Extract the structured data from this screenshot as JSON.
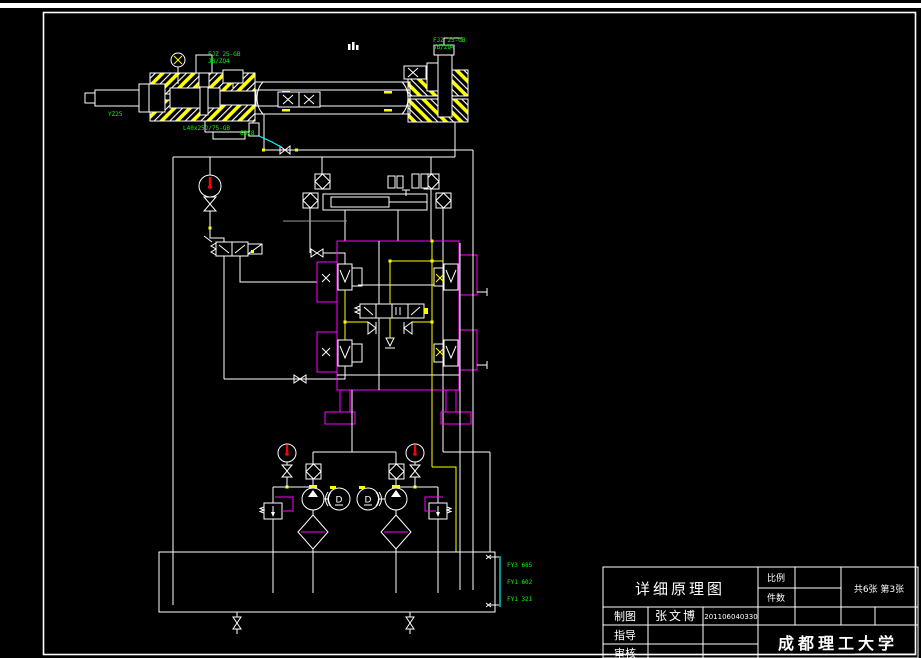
{
  "drawing": {
    "background": "#000000",
    "colors": {
      "main_line": "#FFFFFF",
      "pilot_line": "#FFFF00",
      "block_outline": "#FF00FF",
      "annotation_text": "#00FF00",
      "leader_line": "#00FFFF",
      "gauge_needle": "#FF0000"
    },
    "annotations": {
      "cyl_left_label_1": "FJZ 25-GB",
      "cyl_left_label_2": "JB/ZQ4",
      "cyl_left_edge_label": "YZ25",
      "cyl_left_bottom_label": "L40x25J/75-GB",
      "cyl_right_label_1": "FJZ 25-GB",
      "cyl_right_label_2": "JB/ZQ4",
      "port_label": "G3/8",
      "level_mark_1": "FY3 685",
      "level_mark_2": "FY1 602",
      "level_mark_3": "FY1 321",
      "motor_label": "D"
    },
    "title_block": {
      "title": "详细原理图",
      "scale_label": "比例",
      "qty_label": "件数",
      "sheet_info": "共6张 第3张",
      "drawn_label": "制图",
      "drawn_name": "张文博",
      "drawn_no": "201106040330",
      "advisor_label": "指导",
      "checker_label": "审核",
      "organization": "成都理工大学"
    }
  }
}
